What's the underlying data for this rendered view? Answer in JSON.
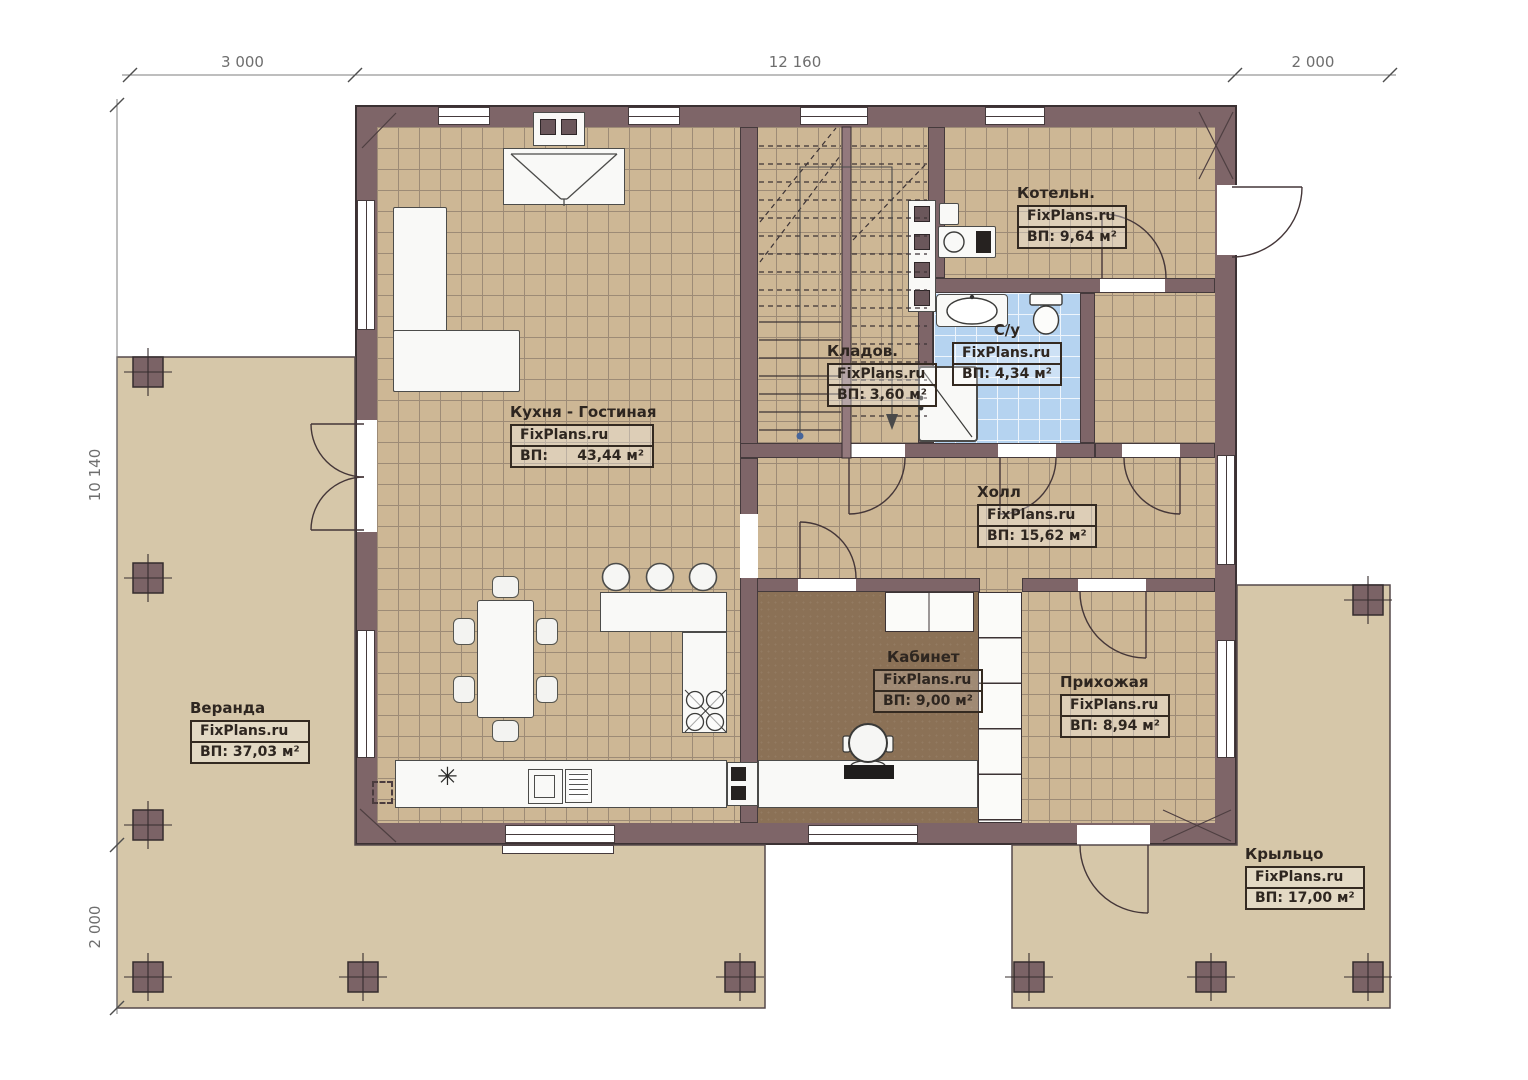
{
  "watermark": "FixPlans.ru",
  "dims": {
    "top1": "3 000",
    "top2": "12 160",
    "top3": "2 000",
    "left1": "10 140",
    "left2": "2 000"
  },
  "rooms": {
    "kitchen_living": {
      "name": "Кухня - Гостиная",
      "area": "ВП:      43,44 м²"
    },
    "boiler": {
      "name": "Котельн.",
      "area": "ВП: 9,64 м²"
    },
    "bathroom": {
      "name": "С/у",
      "area": "ВП: 4,34 м²"
    },
    "storage": {
      "name": "Кладов.",
      "area": "ВП: 3,60 м²"
    },
    "hall": {
      "name": "Холл",
      "area": "ВП: 15,62 м²"
    },
    "office": {
      "name": "Кабинет",
      "area": "ВП: 9,00 м²"
    },
    "entry": {
      "name": "Прихожая",
      "area": "ВП: 8,94 м²"
    },
    "veranda": {
      "name": "Веранда",
      "area": "ВП: 37,03 м²"
    },
    "porch": {
      "name": "Крыльцо",
      "area": "ВП: 17,00 м²"
    }
  },
  "icons": {
    "fridge_symbol": "✳"
  },
  "colors": {
    "wall": "#7e6568",
    "tile": "#cdb795",
    "tile_line": "#9d8b76",
    "veranda": "#d6c7a9",
    "bath_tile": "#b5d3f0",
    "office_floor": "#8b7156"
  }
}
